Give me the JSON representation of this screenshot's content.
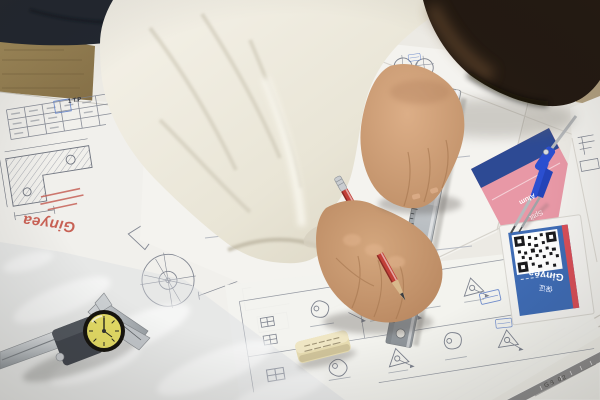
{
  "scene": {
    "type": "photograph",
    "subject": "Engineer drafting with a steel ruler and red pencil over technical drawings",
    "setting": "Wooden desk covered with overlapping engineering blueprint sheets"
  },
  "branding": {
    "logo_left_sheet": "Ginyea",
    "logo_qr_card": "Ginyea",
    "qr_card_cn_label": "保证",
    "pink_card_text_line1": "Alum",
    "pink_card_text_line2": "Sptit"
  },
  "labels": {
    "title_block_stamp": "1 T.P",
    "set_square_text": "GB 02",
    "ruler_num1": "25",
    "ruler_num2": "26"
  },
  "objects": [
    "steel-ruler",
    "red-pencil",
    "dial-caliper",
    "drawing-compass",
    "eraser",
    "qr-code-card",
    "pink-flyer",
    "set-square",
    "blueprint-sheets",
    "plastic-film",
    "right-hand",
    "left-hand",
    "head",
    "white-shirt-sleeve",
    "wooden-desk"
  ],
  "colors": {
    "wood": "#97855a",
    "fabric_dark": "#232831",
    "hair": "#241a12",
    "skin": "#c8997507",
    "shirt": "#eeebdf",
    "paper": "#f3f2ee",
    "line_ink": "#7d828e",
    "pink_card": "#e898a6",
    "card_blue": "#3f6cb5",
    "stripe_red": "#d84f58",
    "compass_blue": "#2b4fd0",
    "dial_yellow": "#e6dd66",
    "pencil_red": "#c23f38",
    "stamp_blue": "#5a7cc8",
    "logo_red": "#c45548"
  }
}
